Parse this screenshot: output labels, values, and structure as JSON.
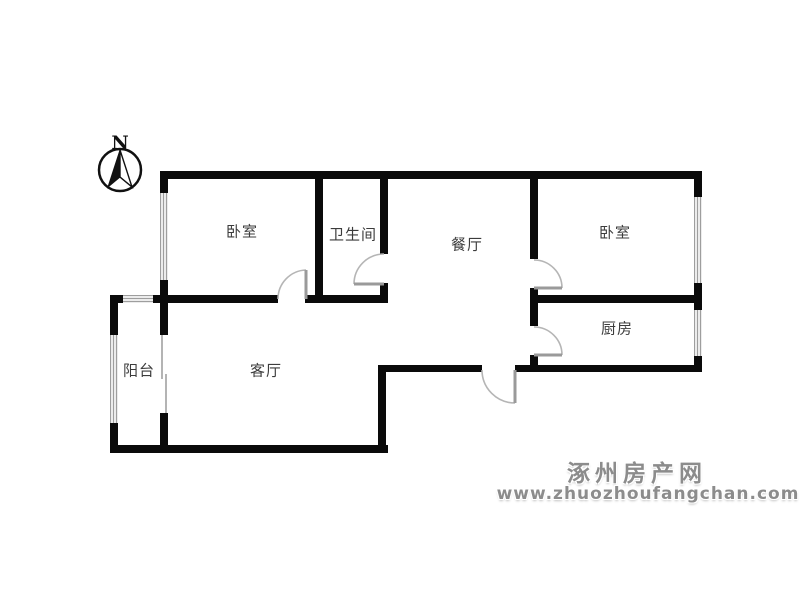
{
  "compass": {
    "label": "N"
  },
  "rooms": {
    "bedroom_left": "卧室",
    "bathroom": "卫生间",
    "dining": "餐厅",
    "bedroom_right": "卧室",
    "kitchen": "厨房",
    "living": "客厅",
    "balcony": "阳台"
  },
  "watermark": {
    "site_name": "涿州房产网",
    "site_url": "www.zhuozhoufangchan.com"
  },
  "colors": {
    "wall": "#0a0a0a",
    "window_frame": "#9e9e9e",
    "door": "#b5b5b5",
    "label_text": "#3c3c3c",
    "watermark_gray": "#8c8c8c"
  }
}
